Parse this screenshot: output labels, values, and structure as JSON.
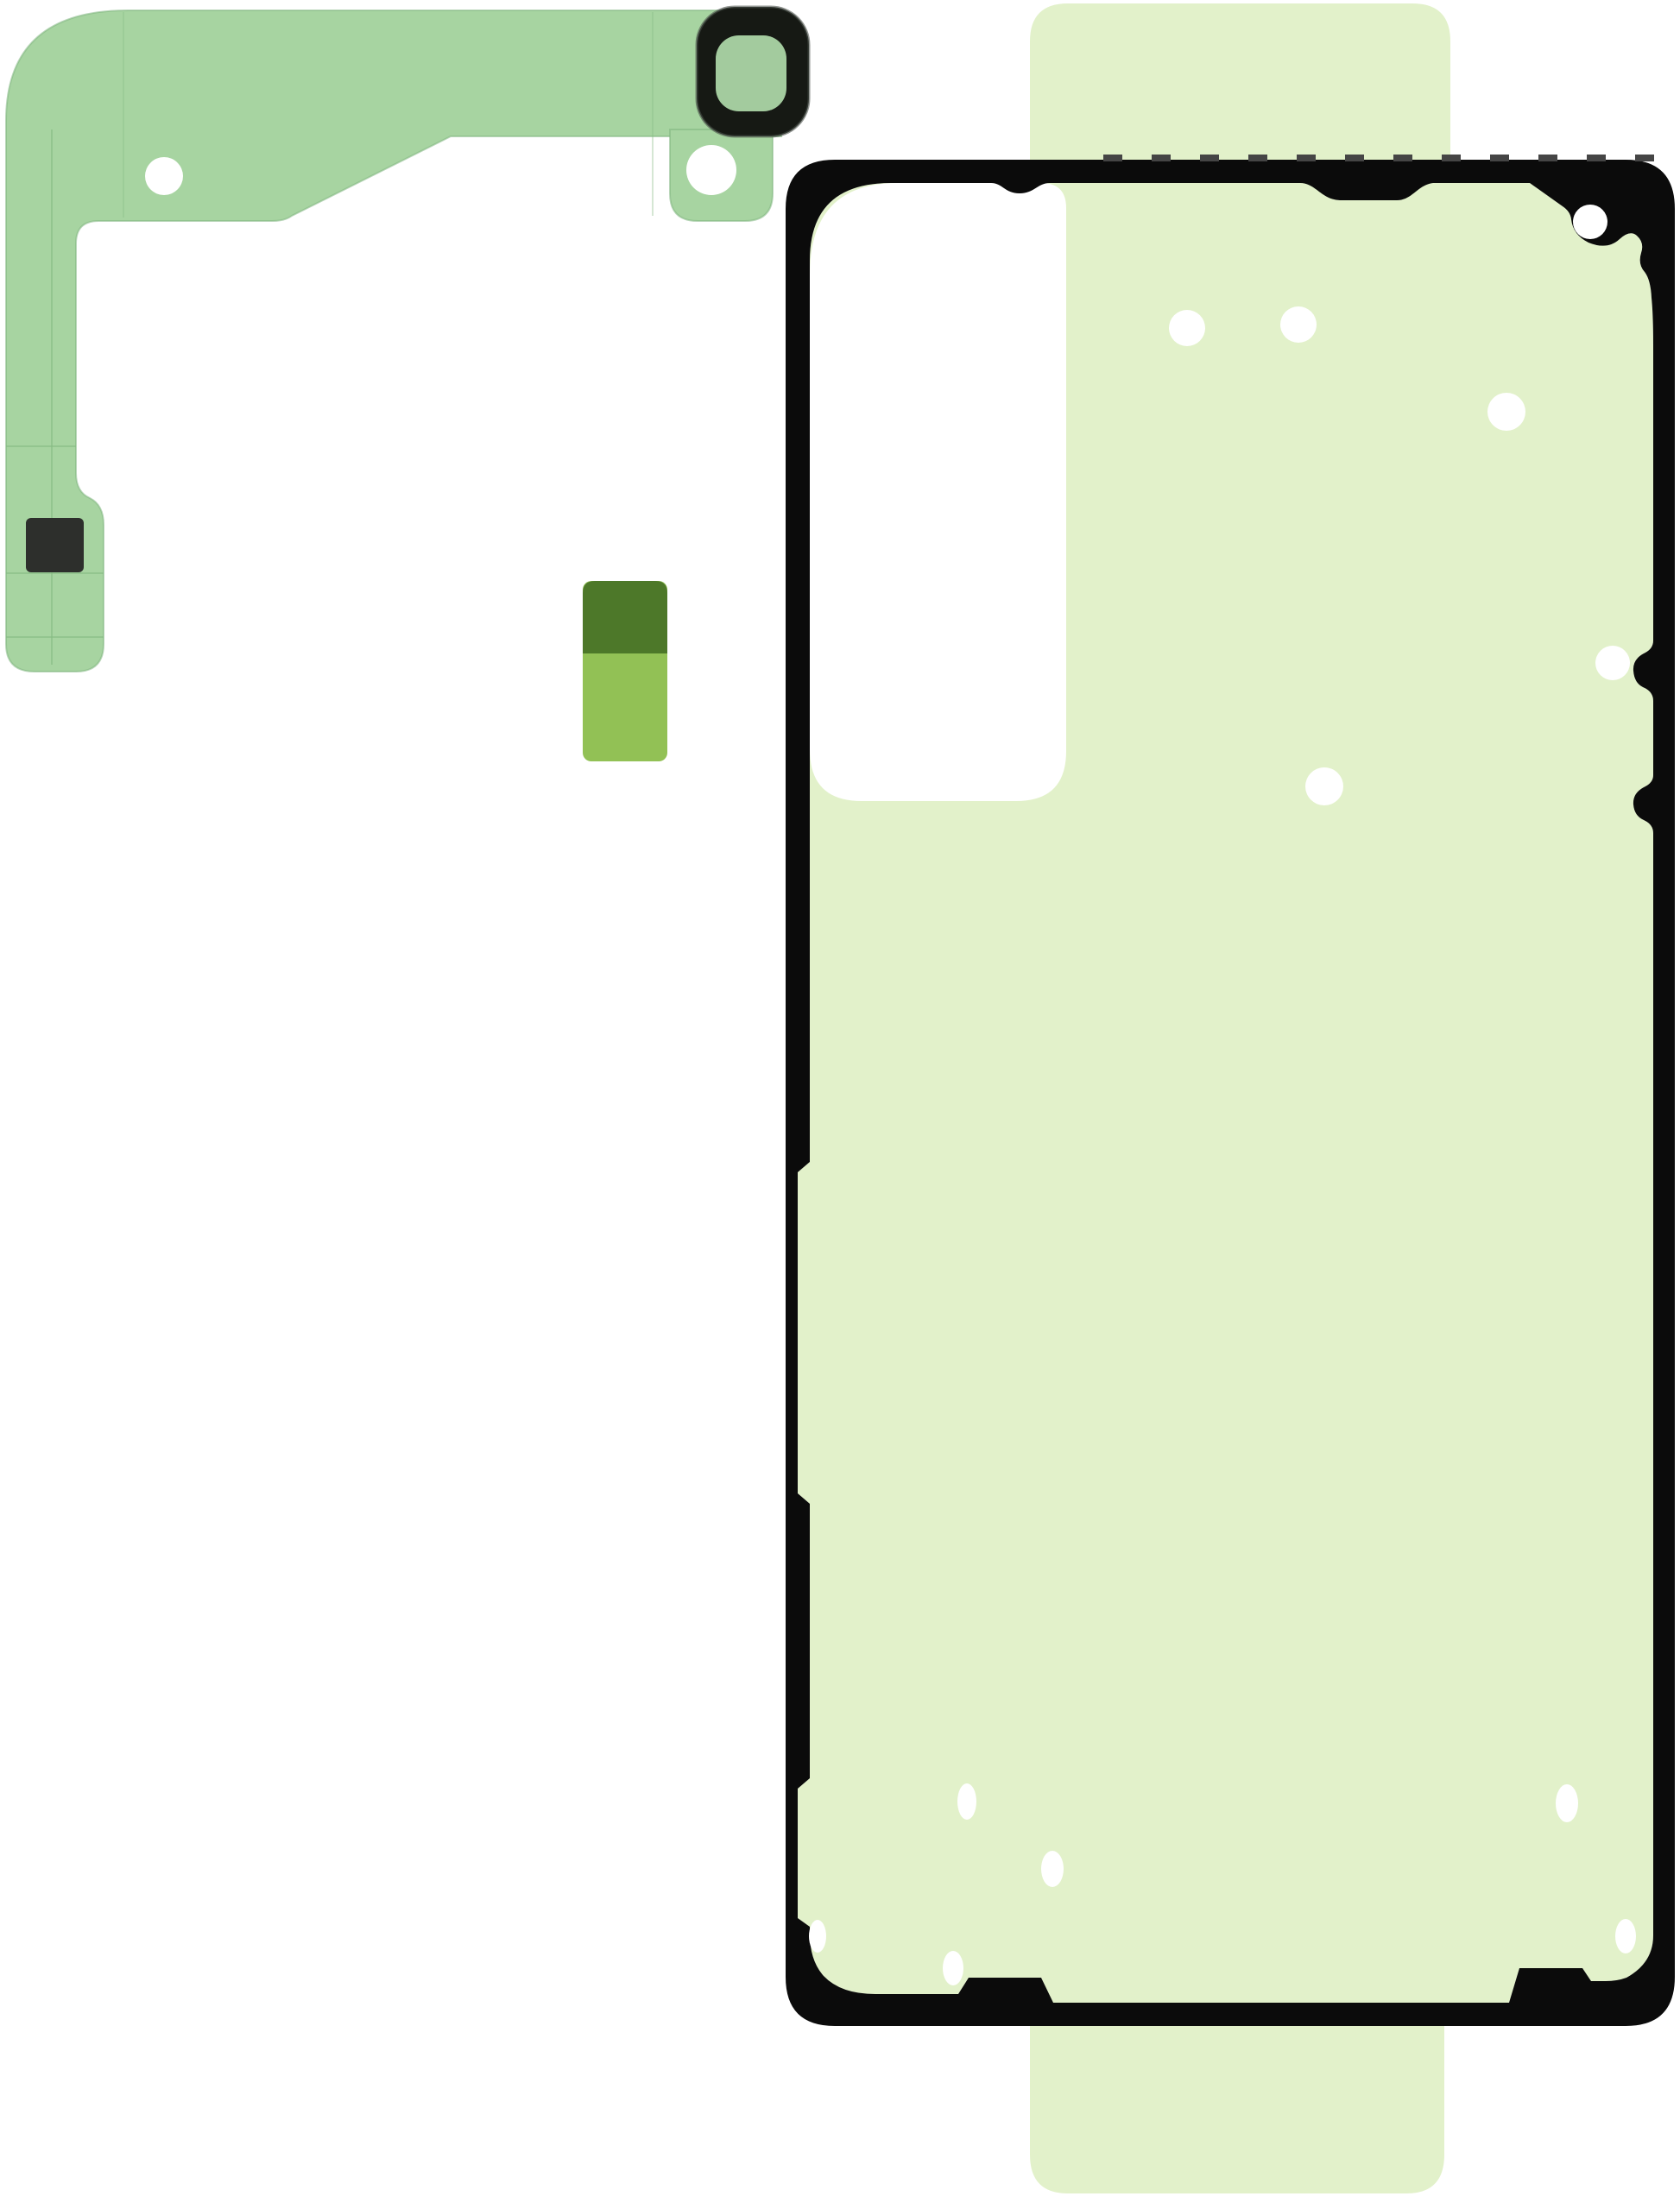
{
  "photo": {
    "subject": "phone-rework-adhesive-kit",
    "pieces": {
      "camera_frame_strip": "camera-frame-adhesive-strip",
      "camera_ring": "camera-lens-ring-adhesive",
      "small_pad": "battery-pull-tab-adhesive",
      "back_cover": "back-cover-adhesive-outline",
      "liner": "protective-liner-tabs"
    }
  },
  "colors": {
    "background": "#ffffff",
    "strip_green": "#a7d4a1",
    "strip_edge": "#7fb57f",
    "strip_crease": "#86bb84",
    "hole_white": "#ffffff",
    "camera_ring_black": "#161914",
    "camera_ring_highlight": "#4a504a",
    "camera_ring_center": "#a3cb9e",
    "pull_square_dark": "#2d2f2c",
    "small_pad_dark": "#4d7829",
    "small_pad_light": "#92c155",
    "liner_pale_green": "#e2f1ca",
    "adhesive_black": "#0b0b0b",
    "tick_gray": "#454545",
    "dot_white": "#ffffff"
  }
}
